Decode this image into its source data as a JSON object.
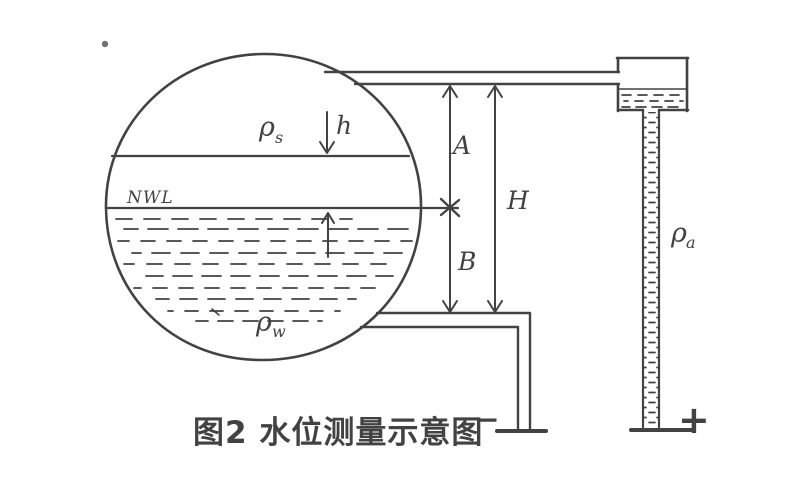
{
  "figure": {
    "caption": "图2  水位测量示意图",
    "labels": {
      "steam_density_base": "ρ",
      "steam_density_sub": "s",
      "water_density_base": "ρ",
      "water_density_sub": "w",
      "reference_density_base": "ρ",
      "reference_density_sub": "a",
      "level_offset": "h",
      "normal_water_level": "NWL",
      "dim_a": "A",
      "dim_b": "B",
      "dim_h": "H",
      "minus": "−",
      "plus": "+"
    },
    "colors": {
      "ink": "#424242",
      "paper": "#ffffff"
    }
  }
}
